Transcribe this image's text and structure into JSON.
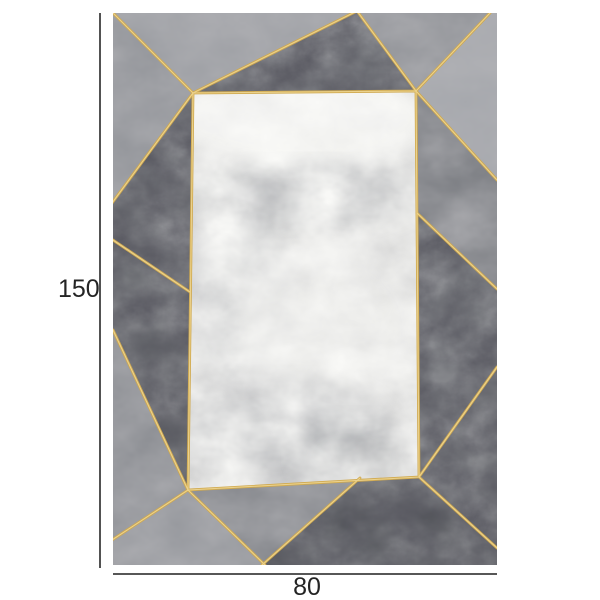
{
  "page": {
    "background_color": "#ffffff",
    "content": "rug-product-photo-with-dimensions"
  },
  "product": {
    "kind": "geometric-marble-rug",
    "dimensions": {
      "height_label": "150",
      "width_label": "80"
    }
  },
  "colors": {
    "gold_accent": "#d0a94f",
    "gold_highlight": "#eed794",
    "dimension_line": "#3f3f3f",
    "label_text": "#242424",
    "rug_inner_panel": "#e2e2e0",
    "rug_mid_gray": "#96989d",
    "rug_dark_gray": "#55575c"
  }
}
